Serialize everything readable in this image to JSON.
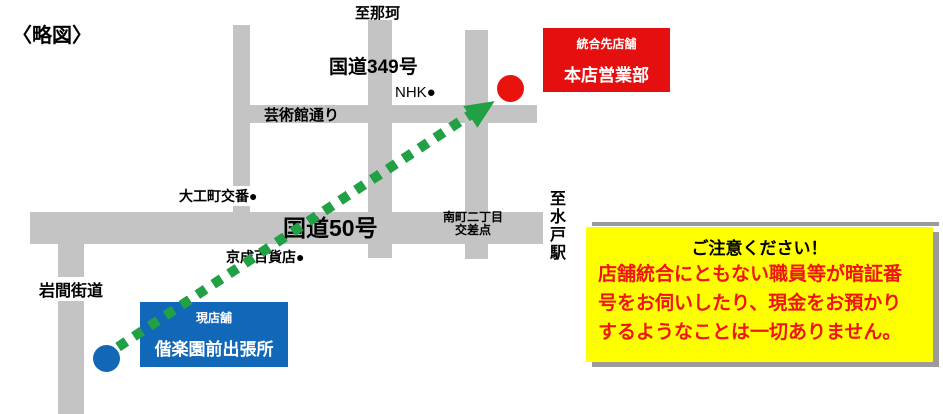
{
  "title": "〈略図〉",
  "map_labels": {
    "to_naka": "至那珂",
    "route_349": "国道349号",
    "nhk": "NHK●",
    "geijutsukan_street": "芸術館通り",
    "daikucho_koban": "大工町交番●",
    "route_50": "国道50号",
    "minamimachi_l1": "南町二丁目",
    "minamimachi_l2": "交差点",
    "keisei_dept": "京成百貨店●",
    "iwama_kaido": "岩間街道",
    "to_mito_station": "至水戸駅"
  },
  "destination_box": {
    "label": "統合先店舗",
    "name": "本店営業部"
  },
  "current_box": {
    "label": "現店舗",
    "name": "偕楽園前出張所"
  },
  "notice": {
    "title": "ご注意ください！",
    "body_lines": [
      "店舗統合にともない職員等が暗証番",
      "号をお伺いしたり、現金をお預かり",
      "するようなことは一切ありません。"
    ]
  },
  "colors": {
    "road_gray": "#c4c4c4",
    "route_green": "#22a045",
    "current_blue": "#1167b8",
    "destination_red": "#e60f0f",
    "notice_yellow": "#ffff00",
    "notice_text_red": "#f01414"
  }
}
